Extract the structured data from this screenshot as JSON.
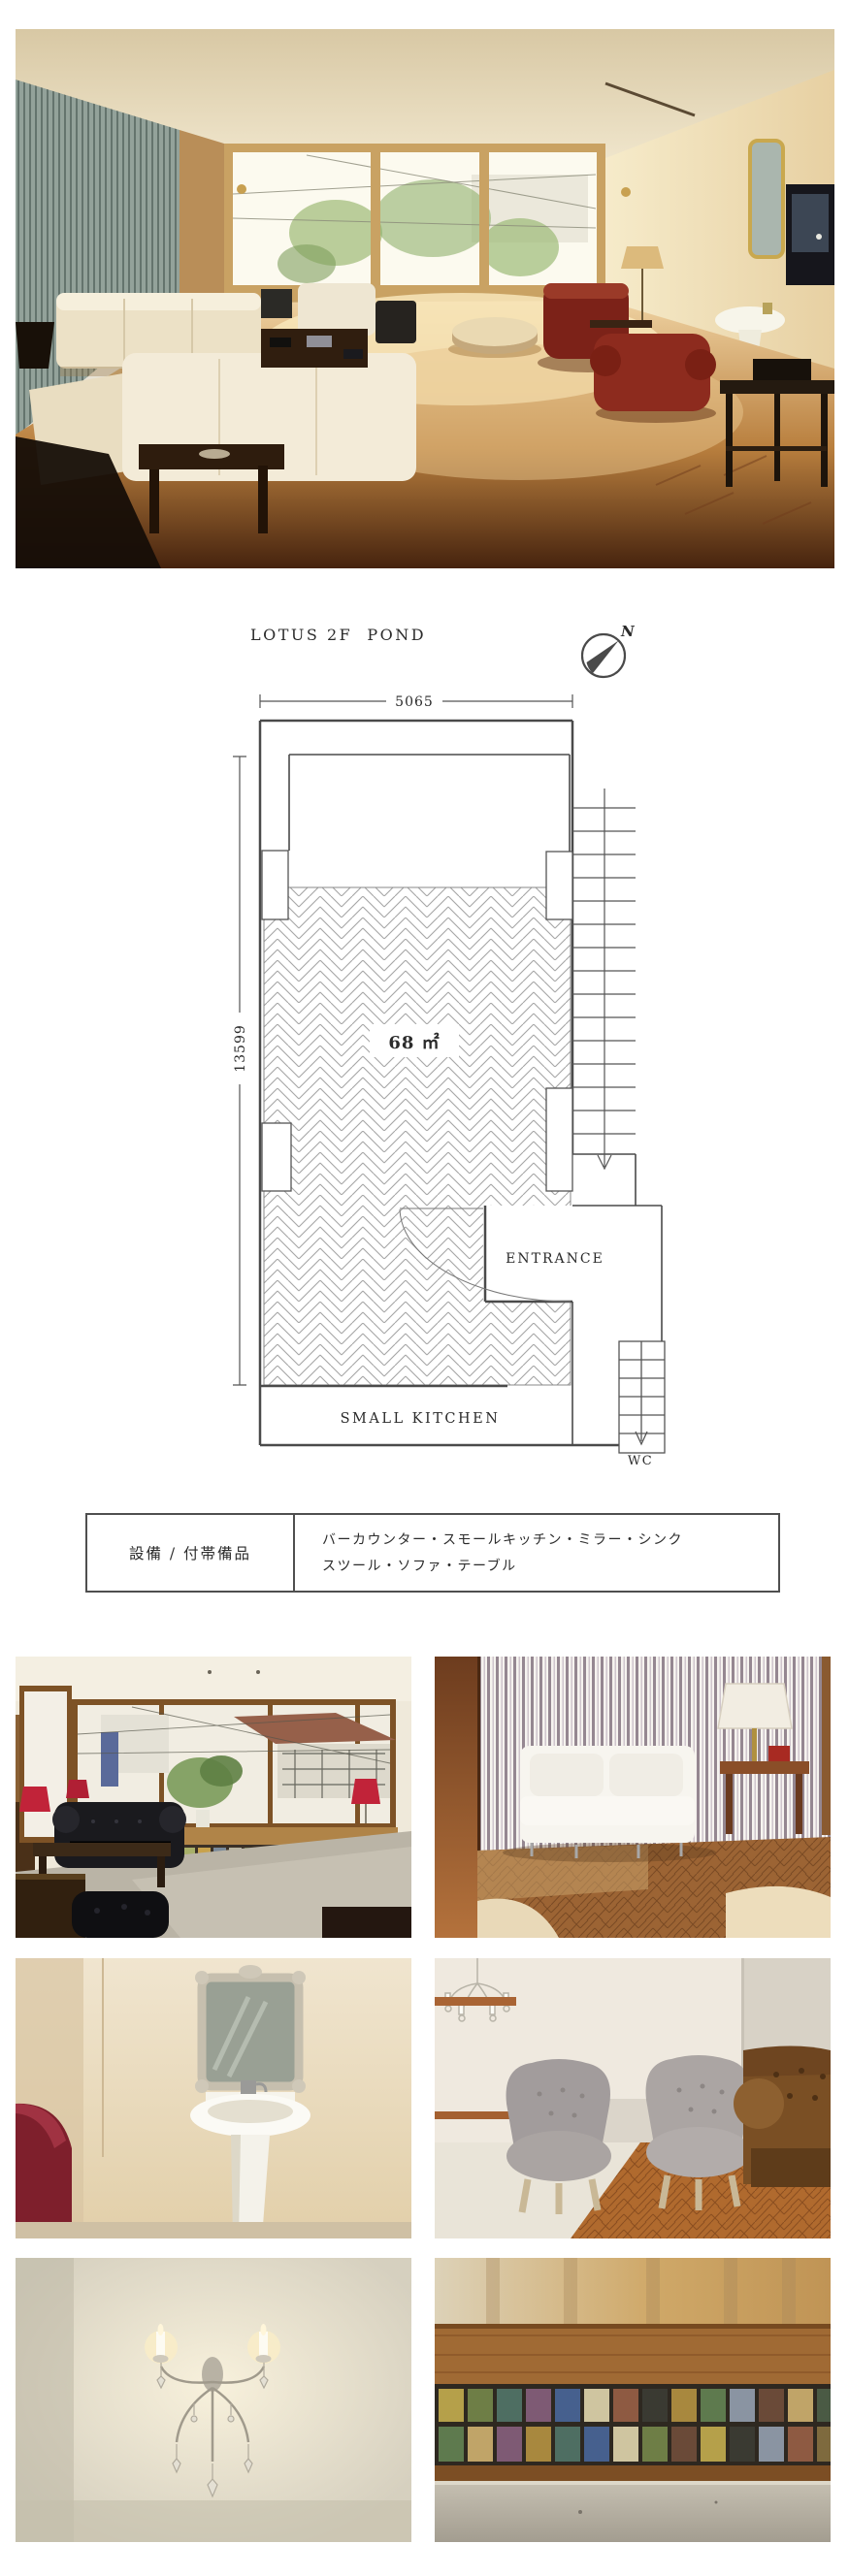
{
  "floor_plan": {
    "title": "LOTUS 2F  POND",
    "compass_north_label": "N",
    "top_dimension": "5065",
    "left_dimension": "13599",
    "area_label": "68 ㎡",
    "entrance_label": "ENTRANCE",
    "small_kitchen_label": "SMALL KITCHEN",
    "wc_label": "WC",
    "line_color": "#4a4a4a",
    "hatch_color": "#a6a6a6",
    "text_color": "#2b2b2b"
  },
  "spec_table": {
    "row_header": "設備 / 付帯備品",
    "equipment_line1": "バーカウンター・スモールキッチン・ミラー・シンク",
    "equipment_line2": "スツール・ソファ・テーブル",
    "border_color": "#4f4f4f"
  },
  "photos": {
    "hero": "sunlit-living-room-with-cream-sofas-and-red-leather-armchairs",
    "row1_left": "lounge-with-black-chesterfield-and-window-view",
    "row1_right": "white-sofa-against-striped-wallpaper-with-table-lamp",
    "row2_left": "powder-room-with-ornate-mirror-pedestal-sink-and-red-chair",
    "row2_right": "two-grey-tufted-chairs-and-brown-chesterfield-on-parquet",
    "row3_left": "crystal-wall-sconce-with-candle-lights",
    "row3_right": "stained-glass-window-band-detail"
  }
}
